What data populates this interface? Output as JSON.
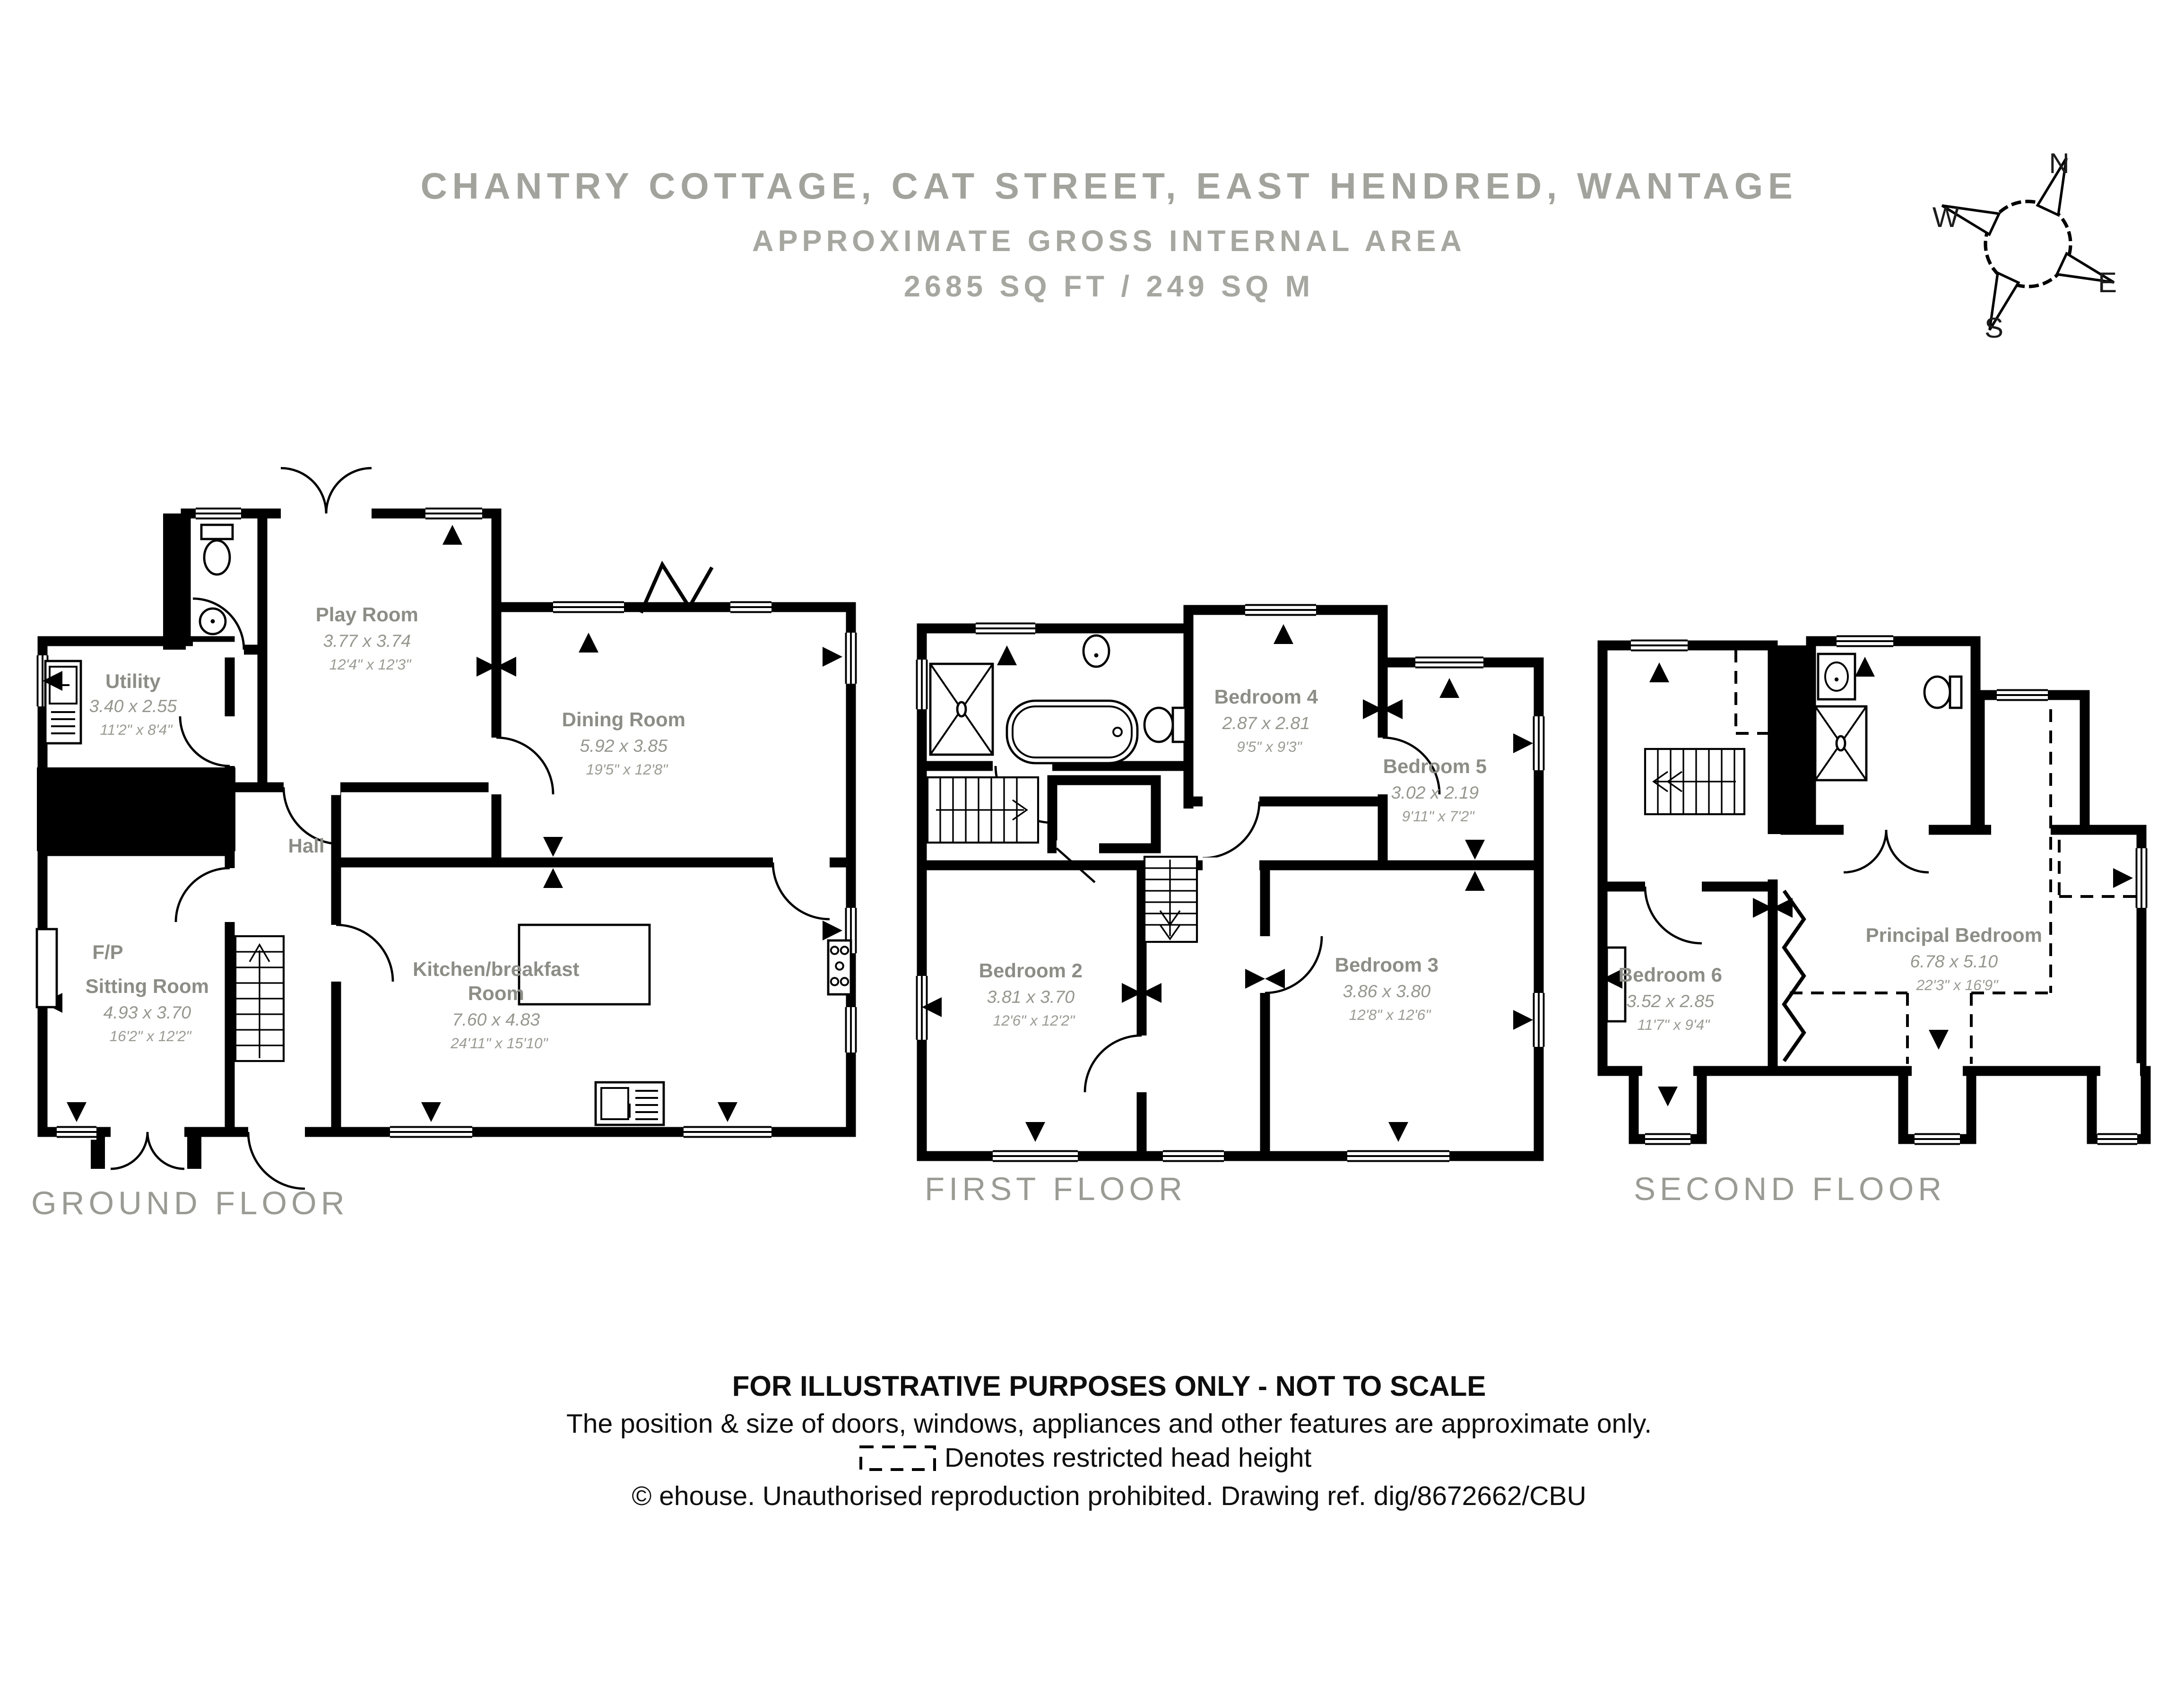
{
  "title": {
    "address": "CHANTRY COTTAGE, CAT STREET, EAST HENDRED, WANTAGE",
    "subtitle": "APPROXIMATE GROSS INTERNAL AREA",
    "area": "2685 SQ FT / 249 SQ M"
  },
  "compass": {
    "north": "N",
    "east": "E",
    "south": "S",
    "west": "W"
  },
  "floors": [
    {
      "label": "GROUND FLOOR",
      "rooms": [
        {
          "name": "Play Room",
          "metric": "3.77 x 3.74",
          "imperial": "12'4\" x 12'3\""
        },
        {
          "name": "Utility",
          "metric": "3.40 x 2.55",
          "imperial": "11'2\" x 8'4\""
        },
        {
          "name": "Dining Room",
          "metric": "5.92 x 3.85",
          "imperial": "19'5\" x 12'8\""
        },
        {
          "name": "Hall"
        },
        {
          "name": "F/P"
        },
        {
          "name": "Sitting Room",
          "metric": "4.93 x 3.70",
          "imperial": "16'2\" x 12'2\""
        },
        {
          "name": "Kitchen/breakfast",
          "name2": "Room",
          "metric": "7.60 x 4.83",
          "imperial": "24'11\" x 15'10\""
        }
      ]
    },
    {
      "label": "FIRST FLOOR",
      "rooms": [
        {
          "name": "Bedroom 4",
          "metric": "2.87 x 2.81",
          "imperial": "9'5\" x 9'3\""
        },
        {
          "name": "Bedroom 5",
          "metric": "3.02 x 2.19",
          "imperial": "9'11\" x 7'2\""
        },
        {
          "name": "Bedroom 2",
          "metric": "3.81 x 3.70",
          "imperial": "12'6\" x 12'2\""
        },
        {
          "name": "Bedroom 3",
          "metric": "3.86 x 3.80",
          "imperial": "12'8\" x 12'6\""
        }
      ]
    },
    {
      "label": "SECOND FLOOR",
      "rooms": [
        {
          "name": "Bedroom 6",
          "metric": "3.52 x 2.85",
          "imperial": "11'7\" x 9'4\""
        },
        {
          "name": "Principal Bedroom",
          "metric": "6.78 x 5.10",
          "imperial": "22'3\" x 16'9\""
        }
      ]
    }
  ],
  "footer": {
    "line1": "FOR ILLUSTRATIVE PURPOSES ONLY - NOT TO SCALE",
    "line2": "The position & size of doors, windows, appliances and other features are approximate only.",
    "line3": "Denotes restricted head height",
    "line4": "© ehouse. Unauthorised reproduction prohibited. Drawing ref. dig/8672662/CBU"
  }
}
